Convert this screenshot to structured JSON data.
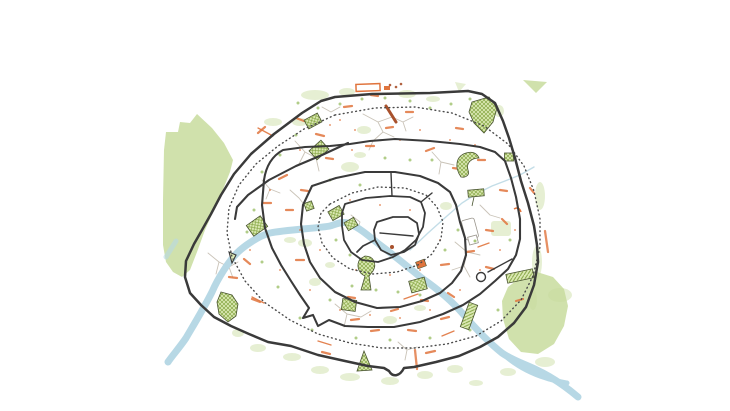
{
  "title": "Ceci n'est pas (tout à fait) Paris",
  "map": {
    "description": "hand-drawn style map of Paris with concentric historic wall rings",
    "river_name": "Seine",
    "features": {
      "outer_ring": "boulevard peripherique wall",
      "dotted_rings": "old boulevards",
      "inner_rings": "historic city walls",
      "west_wood": "Bois de Boulogne",
      "east_wood": "Bois de Vincennes"
    }
  },
  "colors": {
    "background": "#ffffff",
    "title_text": "#3f3f3f",
    "wall": "#3a3a3a",
    "dotted": "#4a4a4a",
    "river": "#b7d8e5",
    "canal": "#bcd9e4",
    "woodland": "#c8dc9e",
    "green_dot": "#a9c87b",
    "park_fill": "#ddeab6",
    "park_hatch": "#86a644",
    "park_stroke": "#4a5531",
    "orange": "#e0743d",
    "brick": "#a8512c",
    "street": "#c7c0b4",
    "outline_gray": "#9a958c"
  }
}
